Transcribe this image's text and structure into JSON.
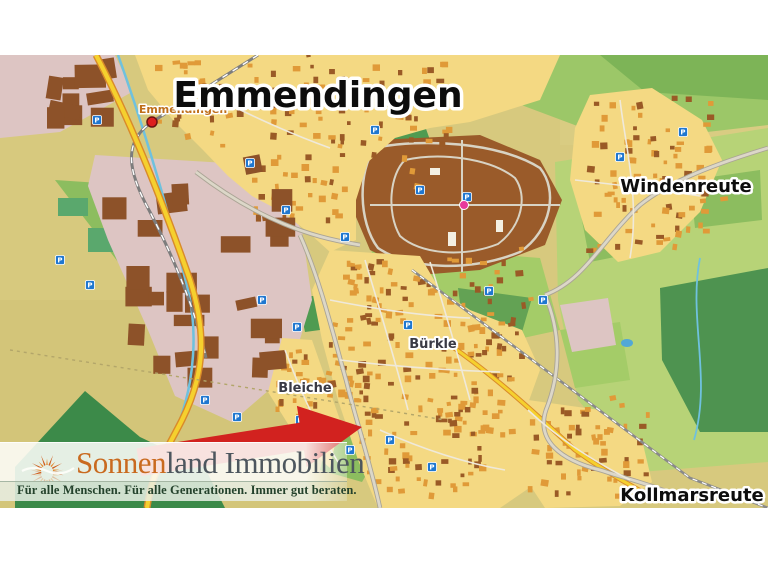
{
  "map": {
    "city_label": "Emmendingen",
    "station_label": "Emmendingen",
    "labels": {
      "windenreute": "Windenreute",
      "buerkle": "Bürkle",
      "bleiche": "Bleiche",
      "kollmarsreute": "Kollmarsreute"
    },
    "marker": {
      "type": "location-arrow",
      "color": "#d2221f"
    }
  },
  "branding": {
    "name_accent": "Sonnen",
    "name_rest": "land Immobilien",
    "tagline": "Für alle Menschen. Für alle Generationen. Immer gut beraten.",
    "accent_color": "#c96a1f",
    "text_color": "#4d565e"
  },
  "icons": {
    "parking_glyph": "P"
  },
  "colors": {
    "farmland": "#d7c97e",
    "residential_yellow": "#f4d983",
    "building_orange": "#e09a38",
    "building_brown": "#9a5a26",
    "industrial_brown": "#8d5229",
    "pink_zone": "#ddc5c3",
    "hospital_brown": "#9a5b2a",
    "green_light": "#b7d377",
    "green_mid": "#8cbd5f",
    "green_dark": "#4e9350",
    "forest": "#3c8a49",
    "road_yellow": "#f5d02e",
    "road_casing": "#d98a2a",
    "road_gray": "#dcd7c8",
    "water_blue": "#6fc1de",
    "parking_blue": "#1f77d0",
    "station_red": "#dd1f1f",
    "hospital_pink": "#e8389b"
  }
}
